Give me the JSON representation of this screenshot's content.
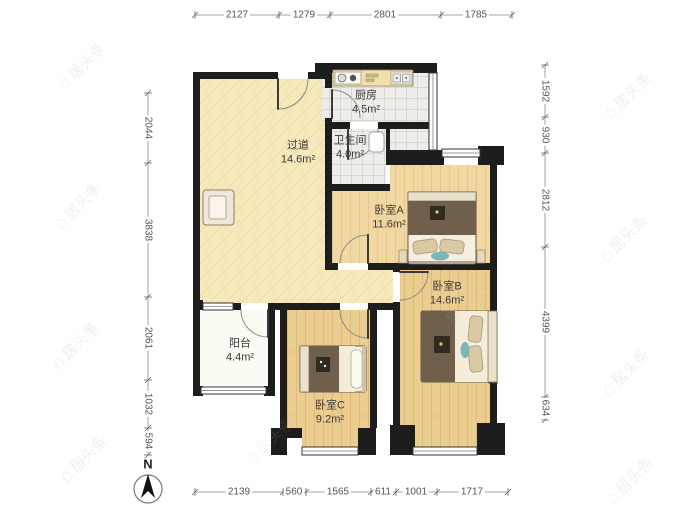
{
  "watermark": {
    "text": "居头条",
    "icon": "house"
  },
  "compass": {
    "label": "N"
  },
  "rooms": {
    "hallway": {
      "name": "过道",
      "area": "14.6m²"
    },
    "kitchen": {
      "name": "厨房",
      "area": "4.5m²"
    },
    "bathroom": {
      "name": "卫生间",
      "area": "4.0m²"
    },
    "bedroomA": {
      "name": "卧室A",
      "area": "11.6m²"
    },
    "bedroomB": {
      "name": "卧室B",
      "area": "14.6m²"
    },
    "bedroomC": {
      "name": "卧室C",
      "area": "9.2m²"
    },
    "balcony": {
      "name": "阳台",
      "area": "4.4m²"
    }
  },
  "dimensions": {
    "top": [
      {
        "label": "2127",
        "pos": 237
      },
      {
        "label": "1279",
        "pos": 304
      },
      {
        "label": "2801",
        "pos": 385
      },
      {
        "label": "1785",
        "pos": 476
      }
    ],
    "bottom": [
      {
        "label": "2139",
        "pos": 239
      },
      {
        "label": "560",
        "pos": 294
      },
      {
        "label": "1565",
        "pos": 338
      },
      {
        "label": "611",
        "pos": 383
      },
      {
        "label": "1001",
        "pos": 416
      },
      {
        "label": "1717",
        "pos": 472
      }
    ],
    "left": [
      {
        "label": "2044",
        "pos": 128
      },
      {
        "label": "3838",
        "pos": 230
      },
      {
        "label": "2061",
        "pos": 338
      },
      {
        "label": "1032",
        "pos": 404
      },
      {
        "label": "594",
        "pos": 441
      }
    ],
    "right": [
      {
        "label": "1592",
        "pos": 91
      },
      {
        "label": "930",
        "pos": 135
      },
      {
        "label": "2812",
        "pos": 200
      },
      {
        "label": "4399",
        "pos": 322
      },
      {
        "label": "634",
        "pos": 408
      }
    ]
  },
  "colors": {
    "wall": "#1d1d1d",
    "wood_bedroomA": "#f0d8a0",
    "wood_bedroomBC": "#eccd90",
    "hallway_floor": "#f5e9bc",
    "tile_floor": "#eeedea",
    "balcony_floor": "#fbfaf3",
    "blanket_brown": "#6f5f4b",
    "accent_teal": "#79b7b9",
    "counter_cream": "#f1e0a8"
  }
}
